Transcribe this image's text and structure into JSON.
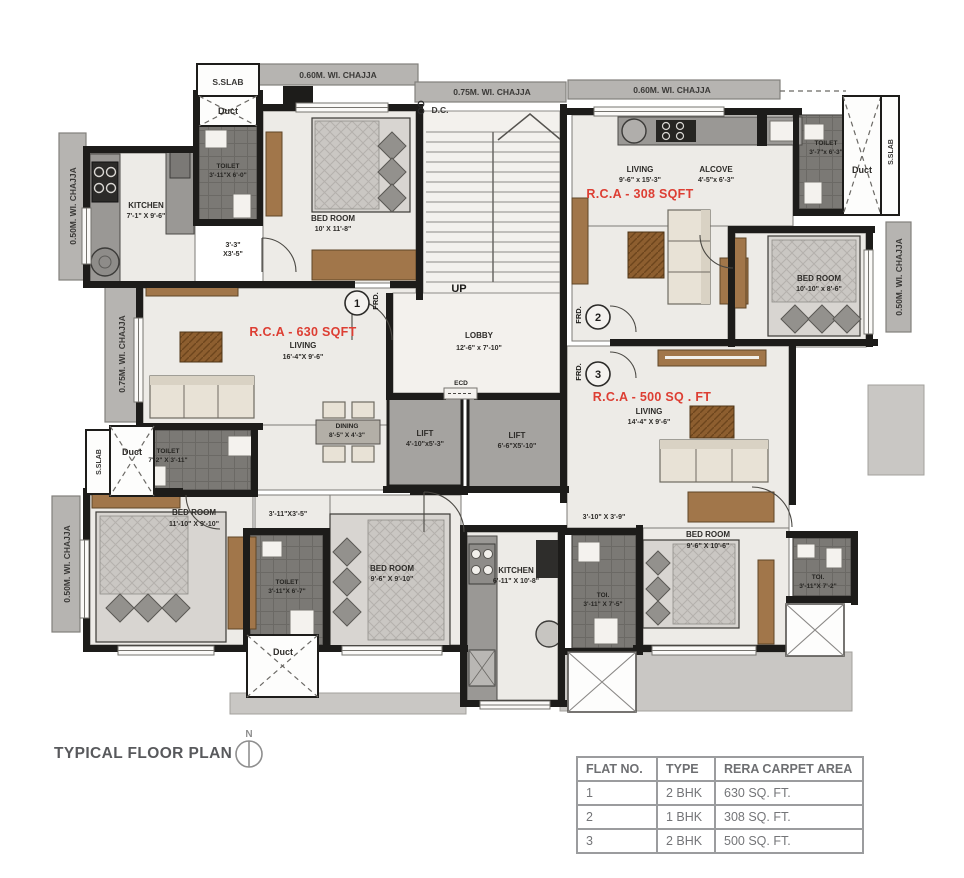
{
  "title": "TYPICAL FLOOR PLAN",
  "north": "N",
  "edge": {
    "chajja_060": "0.60M. WI. CHAJJA",
    "chajja_075": "0.75M. WI. CHAJJA",
    "chajja_050": "0.50M. WI. CHAJJA",
    "sslab": "S.SLAB",
    "duct": "Duct",
    "dc": "D.C."
  },
  "common": {
    "up": "UP",
    "ecd": "ECD",
    "frd": "FRD.",
    "frd_1": "1",
    "frd_2": "2",
    "frd_3": "3",
    "lobby": {
      "name": "LOBBY",
      "dims": "12'-6\" x 7'-10\""
    },
    "lift1": {
      "name": "LIFT",
      "dims": "4'-10\"x5'-3\""
    },
    "lift2": {
      "name": "LIFT",
      "dims": "6'-6\"X5'-10\""
    }
  },
  "flat1": {
    "rca": "R.C.A - 630 SQFT",
    "living": {
      "name": "LIVING",
      "dims": "16'-4\"X 9'-6\""
    },
    "kitchen": {
      "name": "KITCHEN",
      "dims": "7'-1\" X 9'-6\""
    },
    "toilet_top": {
      "name": "TOILET",
      "dims": "3'-11\"X 6'-0\""
    },
    "bedroom_top": {
      "name": "BED ROOM",
      "dims": "10' X 11'-8\""
    },
    "passage_top_l1": "3'-3\"",
    "passage_top_l2": "X3'-5\"",
    "dining": {
      "name": "DINING",
      "dims": "8'-5\" X 4'-3\""
    },
    "toilet_mid": {
      "name": "TOILET",
      "dims": "7'-2\" X 3'-11\""
    },
    "bedroom_left": {
      "name": "BED ROOM",
      "dims": "11'-10\" X 9'-10\""
    },
    "passage_bottom": "3'-11\"X3'-5\"",
    "toilet_bottom": {
      "name": "TOILET",
      "dims": "3'-11\"X 6'-7\""
    },
    "bedroom_mid": {
      "name": "BED ROOM",
      "dims": "9'-6\" X 9'-10\""
    }
  },
  "flat2": {
    "rca": "R.C.A - 308 SQFT",
    "living": {
      "name": "LIVING",
      "dims": "9'-6\" x 15'-3\""
    },
    "alcove": {
      "name": "ALCOVE",
      "dims": "4'-5\"x 6'-3\""
    },
    "toilet": {
      "name": "TOILET",
      "dims": "3'-7\"x 6'-3\""
    },
    "bedroom": {
      "name": "BED ROOM",
      "dims": "10'-10\" x 8'-6\""
    }
  },
  "flat3": {
    "rca": "R.C.A - 500 SQ . FT",
    "living": {
      "name": "LIVING",
      "dims": "14'-4\" X 9'-6\""
    },
    "passage": "3'-10\" X 3'-9\"",
    "kitchen": {
      "name": "KITCHEN",
      "dims": "6'-11\" X 10'-8\""
    },
    "toi_left": {
      "name": "TOI.",
      "dims": "3'-11\" X 7'-5\""
    },
    "bedroom": {
      "name": "BED ROOM",
      "dims": "9'-6\" X 10'-6\""
    },
    "toi_right": {
      "name": "TOI.",
      "dims": "3'-11\"X 7'-2\""
    }
  },
  "table": {
    "headers": [
      "FLAT NO.",
      "TYPE",
      "RERA CARPET AREA"
    ],
    "rows": [
      {
        "flat_no": "1",
        "type": "2 BHK",
        "area": "630 SQ. FT."
      },
      {
        "flat_no": "2",
        "type": "1 BHK",
        "area": "308 SQ. FT."
      },
      {
        "flat_no": "3",
        "type": "2 BHK",
        "area": "500 SQ. FT."
      }
    ]
  },
  "colors": {
    "rca_red": "#dd3e33",
    "wall_black": "#1d1c1a",
    "chajja_grey": "#b6b4b1",
    "tile_dark": "#7b7975",
    "floor_marble": "#edebe7",
    "wood": "#a1764a"
  }
}
